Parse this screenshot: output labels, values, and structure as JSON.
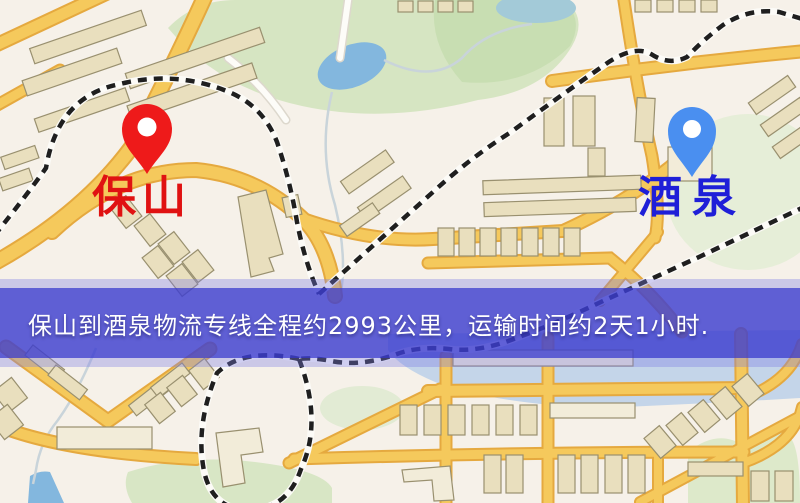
{
  "banner": {
    "text": "保山到酒泉物流专线全程约2993公里，运输时间约2天1小时.",
    "background_color": "#3436cd",
    "text_color": "#ffffff"
  },
  "route": {
    "origin": "保山",
    "destination": "酒泉",
    "distance_km": "2993",
    "duration": "2天1小时"
  },
  "pins": {
    "baoshan": {
      "label": "保山",
      "color": "#ee1a1a",
      "label_color": "#e01212"
    },
    "jiuquan": {
      "label": "酒泉",
      "color": "#4a8ff0",
      "label_color": "#1f1fd8"
    }
  },
  "map_colors": {
    "background": "#f6f1e9",
    "road_yellow": "#f5c95c",
    "road_casing": "#e5a93f",
    "park_green": "#d6e5c2",
    "water_blue": "#83b7de",
    "building_tan": "#e9dfbe",
    "railway_black": "#1f1f1f"
  }
}
